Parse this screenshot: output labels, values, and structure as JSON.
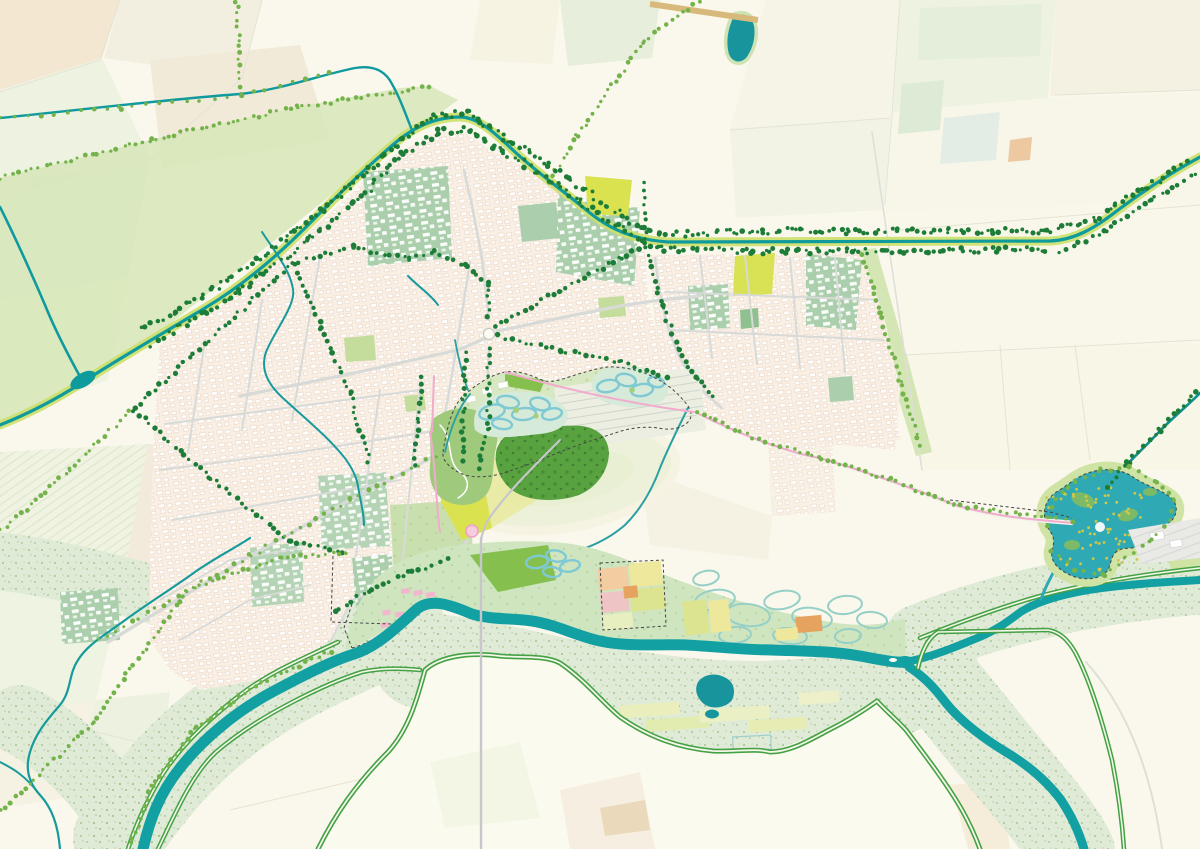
{
  "map": {
    "kind": "landscape-masterplan-map",
    "description": "urban river landscape masterplan with city grid, canal ring, restored river park, floodplain and lake",
    "colors": {
      "background": "#faf8ec",
      "river": "#12a0a2",
      "canal": "#0f9a9d",
      "canal_dark": "#0d9093",
      "lake": "#2fa9b3",
      "pond_dark": "#17949c",
      "floodplain": "#dfebd7",
      "speckle": "#a6c18f",
      "levee_green": "#44a144",
      "park_base": "#cfe5c0",
      "park_lobe": "#d7e8c2",
      "woods": "#58a340",
      "meadow": "#82bf4c",
      "garden": "#9fca7c",
      "city_base": "#f9efe4",
      "city_line": "#ecd9c8",
      "sage_block": "#abcfad",
      "street_gray": "#d8dad8",
      "chartreuse": "#dbe24f",
      "verge_yellow": "#ccdf6a",
      "tree_dark": "#1d7d38",
      "tree_light": "#74b34c",
      "braided_channel": "#7fc9d4",
      "route_pink": "#f2abcd",
      "boundary_dash": "#454545",
      "field_yellow": "#eee89c",
      "field_orange": "#e6a35f",
      "field_peach": "#f2cda1",
      "field_pink": "#eec4c4",
      "field_lime": "#dce48f",
      "lake_speckle": "#d2c74a"
    },
    "features": [
      {
        "name": "main-river",
        "color_key": "river"
      },
      {
        "name": "ring-canal",
        "color_key": "canal"
      },
      {
        "name": "recreation-lake",
        "color_key": "lake"
      },
      {
        "name": "floodplain-meadows",
        "color_key": "floodplain"
      },
      {
        "name": "levee-roads",
        "color_key": "levee_green"
      },
      {
        "name": "city-fabric",
        "color_key": "city_base"
      },
      {
        "name": "institutional-blocks",
        "color_key": "sage_block"
      },
      {
        "name": "central-park",
        "color_key": "park_lobe"
      },
      {
        "name": "river-restoration-park",
        "color_key": "park_base"
      },
      {
        "name": "braided-side-channels",
        "color_key": "braided_channel"
      },
      {
        "name": "tree-lined-avenues",
        "color_key": "tree_dark"
      },
      {
        "name": "cycling-route",
        "color_key": "route_pink"
      },
      {
        "name": "project-boundary",
        "color_key": "boundary_dash"
      },
      {
        "name": "agricultural-patchwork",
        "color_key": "field_yellow"
      }
    ]
  },
  "tree_lines": [
    {
      "style": "dark",
      "pts": [
        [
          135,
          408
        ],
        [
          293,
          263
        ]
      ]
    },
    {
      "style": "dark",
      "pts": [
        [
          293,
          263
        ],
        [
          352,
          247
        ],
        [
          410,
          259
        ],
        [
          433,
          252
        ]
      ]
    },
    {
      "style": "dark",
      "pts": [
        [
          433,
          252
        ],
        [
          467,
          266
        ],
        [
          488,
          284
        ],
        [
          489,
          318
        ]
      ]
    },
    {
      "style": "dark",
      "pts": [
        [
          489,
          349
        ],
        [
          488,
          430
        ],
        [
          478,
          468
        ]
      ]
    },
    {
      "style": "dark",
      "pts": [
        [
          498,
          336
        ],
        [
          560,
          350
        ],
        [
          620,
          362
        ],
        [
          666,
          379
        ]
      ]
    },
    {
      "style": "dark",
      "pts": [
        [
          496,
          326
        ],
        [
          560,
          290
        ],
        [
          620,
          258
        ],
        [
          644,
          247
        ]
      ]
    },
    {
      "style": "dark",
      "pts": [
        [
          645,
          240
        ],
        [
          645,
          184
        ]
      ]
    },
    {
      "style": "dark",
      "pts": [
        [
          465,
          354
        ],
        [
          462,
          460
        ]
      ]
    },
    {
      "style": "dark",
      "pts": [
        [
          421,
          377
        ],
        [
          415,
          464
        ]
      ]
    },
    {
      "style": "dark",
      "pts": [
        [
          294,
          266
        ],
        [
          322,
          328
        ],
        [
          350,
          393
        ],
        [
          369,
          462
        ]
      ]
    },
    {
      "style": "dark",
      "pts": [
        [
          134,
          410
        ],
        [
          210,
          478
        ],
        [
          290,
          540
        ],
        [
          344,
          553
        ]
      ]
    },
    {
      "style": "dark",
      "pts": [
        [
          650,
          254
        ],
        [
          662,
          306
        ],
        [
          678,
          348
        ],
        [
          697,
          378
        ],
        [
          714,
          398
        ]
      ]
    },
    {
      "style": "light",
      "pts": [
        [
          0,
          178
        ],
        [
          150,
          140
        ],
        [
          297,
          107
        ],
        [
          428,
          87
        ]
      ]
    },
    {
      "style": "light",
      "pts": [
        [
          700,
          1
        ],
        [
          643,
          42
        ],
        [
          577,
          135
        ],
        [
          549,
          182
        ]
      ]
    },
    {
      "style": "light",
      "pts": [
        [
          237,
          1
        ],
        [
          240,
          93
        ]
      ]
    },
    {
      "style": "light",
      "pts": [
        [
          1,
          531
        ],
        [
          70,
          470
        ],
        [
          130,
          411
        ]
      ]
    },
    {
      "style": "light",
      "pts": [
        [
          1,
          811
        ],
        [
          93,
          723
        ],
        [
          187,
          590
        ],
        [
          280,
          558
        ],
        [
          346,
          552
        ]
      ]
    },
    {
      "style": "light",
      "pts": [
        [
          697,
          413
        ],
        [
          760,
          440
        ],
        [
          820,
          458
        ],
        [
          890,
          480
        ],
        [
          955,
          505
        ],
        [
          1048,
          517
        ],
        [
          1072,
          522
        ]
      ]
    },
    {
      "style": "dark",
      "spacing": 5,
      "jitter": 3,
      "pts": [
        [
          152,
          344
        ],
        [
          240,
          292
        ],
        [
          310,
          238
        ],
        [
          362,
          196
        ],
        [
          402,
          155
        ],
        [
          440,
          131
        ],
        [
          470,
          129
        ],
        [
          500,
          149
        ],
        [
          540,
          173
        ],
        [
          580,
          201
        ],
        [
          622,
          229
        ],
        [
          660,
          249
        ],
        [
          750,
          251
        ],
        [
          850,
          251
        ],
        [
          950,
          251
        ],
        [
          1046,
          249
        ]
      ]
    },
    {
      "style": "dark",
      "spacing": 5,
      "jitter": 3,
      "pts": [
        [
          142,
          330
        ],
        [
          230,
          279
        ],
        [
          300,
          227
        ],
        [
          352,
          187
        ],
        [
          396,
          145
        ],
        [
          436,
          116
        ],
        [
          468,
          113
        ],
        [
          506,
          139
        ],
        [
          546,
          163
        ],
        [
          586,
          191
        ],
        [
          626,
          219
        ],
        [
          662,
          235
        ],
        [
          750,
          231
        ],
        [
          850,
          231
        ],
        [
          950,
          231
        ],
        [
          1046,
          231
        ],
        [
          1096,
          219
        ],
        [
          1140,
          191
        ],
        [
          1186,
          164
        ]
      ]
    },
    {
      "style": "dark",
      "pts": [
        [
          1060,
          253
        ],
        [
          1105,
          231
        ],
        [
          1150,
          201
        ],
        [
          1196,
          173
        ]
      ]
    },
    {
      "style": "dark",
      "pts": [
        [
          1197,
          391
        ],
        [
          1160,
          430
        ],
        [
          1128,
          462
        ],
        [
          1106,
          489
        ]
      ]
    },
    {
      "style": "light",
      "pts": [
        [
          330,
          651
        ],
        [
          262,
          683
        ],
        [
          196,
          728
        ],
        [
          152,
          786
        ],
        [
          131,
          844
        ]
      ]
    },
    {
      "style": "light",
      "spacing": 8,
      "pts": [
        [
          1048,
          526
        ],
        [
          1056,
          498
        ],
        [
          1076,
          482
        ],
        [
          1100,
          470
        ],
        [
          1128,
          468
        ],
        [
          1156,
          481
        ],
        [
          1175,
          499
        ],
        [
          1170,
          521
        ],
        [
          1150,
          540
        ],
        [
          1126,
          558
        ],
        [
          1103,
          574
        ],
        [
          1074,
          570
        ],
        [
          1052,
          551
        ]
      ]
    },
    {
      "style": "light",
      "pts": [
        [
          862,
          256
        ],
        [
          880,
          312
        ],
        [
          900,
          380
        ],
        [
          920,
          446
        ]
      ]
    },
    {
      "style": "dark",
      "pts": [
        [
          334,
          612
        ],
        [
          370,
          590
        ],
        [
          410,
          572
        ],
        [
          447,
          560
        ]
      ]
    },
    {
      "style": "light",
      "spacing": 13,
      "pts": [
        [
          2,
          118
        ],
        [
          120,
          108
        ],
        [
          240,
          95
        ],
        [
          330,
          73
        ]
      ]
    },
    {
      "style": "light",
      "spacing": 9,
      "pts": [
        [
          100,
          640
        ],
        [
          250,
          556
        ],
        [
          350,
          500
        ],
        [
          436,
          456
        ]
      ]
    }
  ],
  "lake_speckle": {
    "count": 70,
    "zones": [
      [
        1095,
        505,
        52,
        26
      ],
      [
        1105,
        552,
        48,
        24
      ]
    ],
    "r": 1.4
  }
}
